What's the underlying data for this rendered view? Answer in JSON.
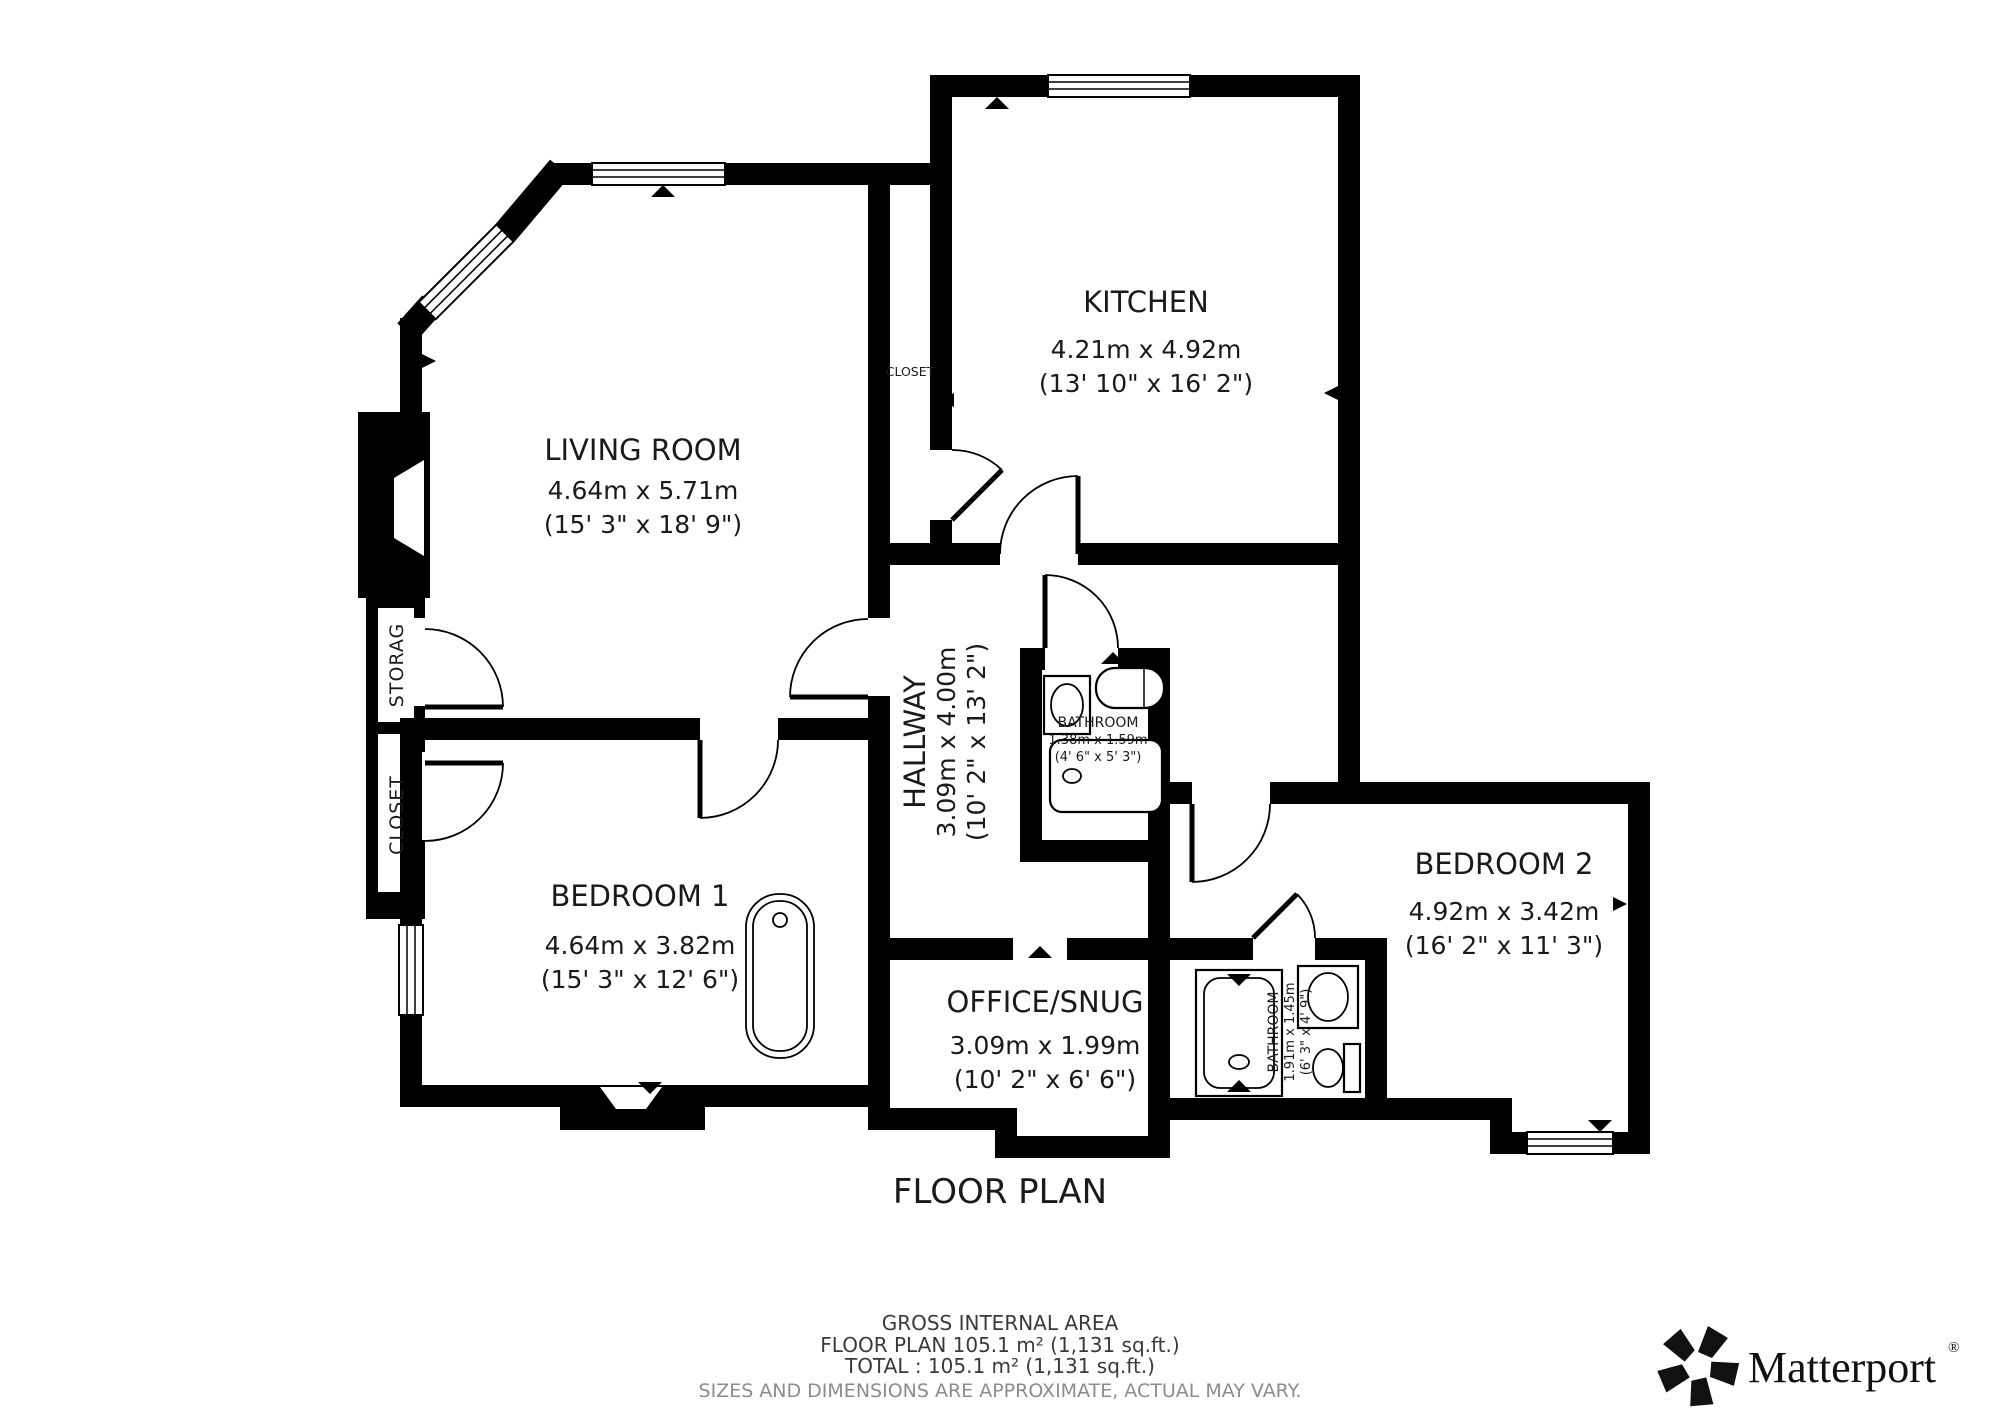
{
  "colors": {
    "wall": "#000000",
    "text": "#1a1a1a",
    "muted": "#8c8c8c",
    "background": "#ffffff"
  },
  "rooms": {
    "kitchen": {
      "name": "KITCHEN",
      "metric": "4.21m x 4.92m",
      "imperial": "(13' 10\" x 16' 2\")"
    },
    "living_room": {
      "name": "LIVING ROOM",
      "metric": "4.64m x 5.71m",
      "imperial": "(15' 3\" x 18' 9\")"
    },
    "hallway": {
      "name": "HALLWAY",
      "metric": "3.09m x 4.00m",
      "imperial": "(10' 2\" x 13' 2\")"
    },
    "bathroom_1": {
      "name": "BATHROOM",
      "metric": "1.38m x 1.59m",
      "imperial": "(4' 6\" x 5' 3\")"
    },
    "bedroom_1": {
      "name": "BEDROOM 1",
      "metric": "4.64m x 3.82m",
      "imperial": "(15' 3\" x 12' 6\")"
    },
    "office_snug": {
      "name": "OFFICE/SNUG",
      "metric": "3.09m x 1.99m",
      "imperial": "(10' 2\" x 6' 6\")"
    },
    "bathroom_2": {
      "name": "BATHROOM",
      "metric": "1.91m x 1.45m",
      "imperial": "(6' 3\" x 4' 9\")"
    },
    "bedroom_2": {
      "name": "BEDROOM 2",
      "metric": "4.92m x 3.42m",
      "imperial": "(16' 2\" x 11' 3\")"
    },
    "closet_upper": {
      "name": "CLOSET"
    },
    "storage": {
      "name": "STORAG"
    },
    "closet_lower": {
      "name": "CLOSET"
    }
  },
  "plan_title": "FLOOR PLAN",
  "footer": {
    "area_heading": "GROSS INTERNAL AREA",
    "floor_line": "FLOOR PLAN 105.1 m² (1,131 sq.ft.)",
    "total_line": "TOTAL :  105.1 m² (1,131 sq.ft.)",
    "disclaimer": "SIZES AND DIMENSIONS ARE APPROXIMATE, ACTUAL MAY VARY."
  },
  "branding": {
    "name": "Matterport",
    "registered": "®",
    "icon": "matterport-pinwheel-icon"
  }
}
